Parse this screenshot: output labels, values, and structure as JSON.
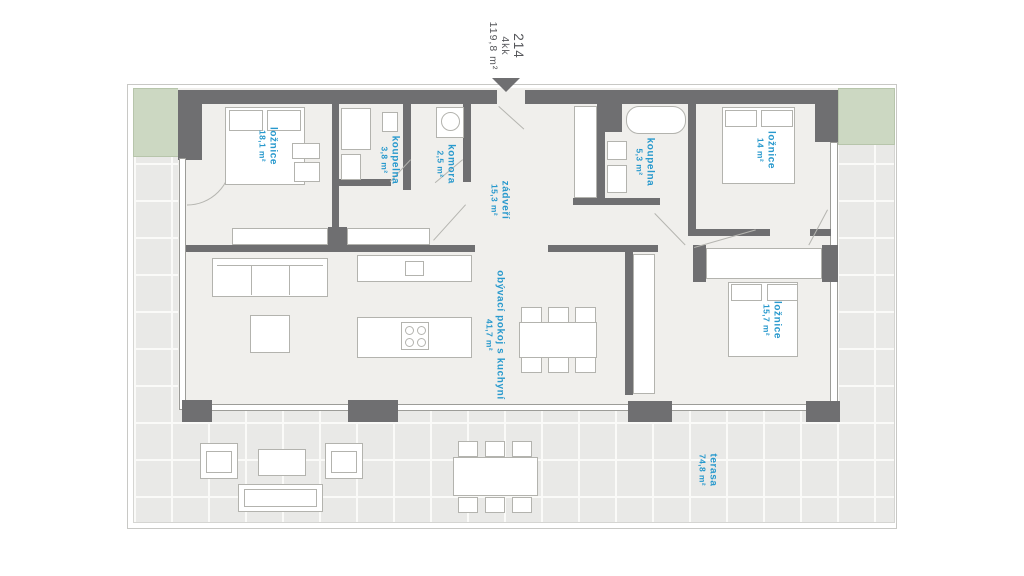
{
  "unit": {
    "number": "214",
    "disposition": "4kk",
    "total_area": "119,8 m²"
  },
  "rooms": {
    "loznice1": {
      "label": "ložnice",
      "area": "18,1 m²"
    },
    "koupelna1": {
      "label": "koupelna",
      "area": "3,8 m²"
    },
    "komora": {
      "label": "komora",
      "area": "2,5 m²"
    },
    "zadveri": {
      "label": "zádveří",
      "area": "15,3 m²"
    },
    "koupelna2": {
      "label": "koupelna",
      "area": "5,3 m²"
    },
    "loznice2": {
      "label": "ložnice",
      "area": "14 m²"
    },
    "loznice3": {
      "label": "ložnice",
      "area": "15,7 m²"
    },
    "obyvaci_pokoj": {
      "label": "obývací pokoj s kuchyní",
      "area": "41,7 m²"
    },
    "terasa": {
      "label": "terasa",
      "area": "74,8 m²"
    }
  },
  "colors": {
    "wall": "#6f6f71",
    "room_label": "#2899cd",
    "title_text": "#55565a",
    "terrace_floor": "#e9e9e7",
    "planter_green": "#ccd8c2",
    "apartment_floor": "#f0efec"
  }
}
